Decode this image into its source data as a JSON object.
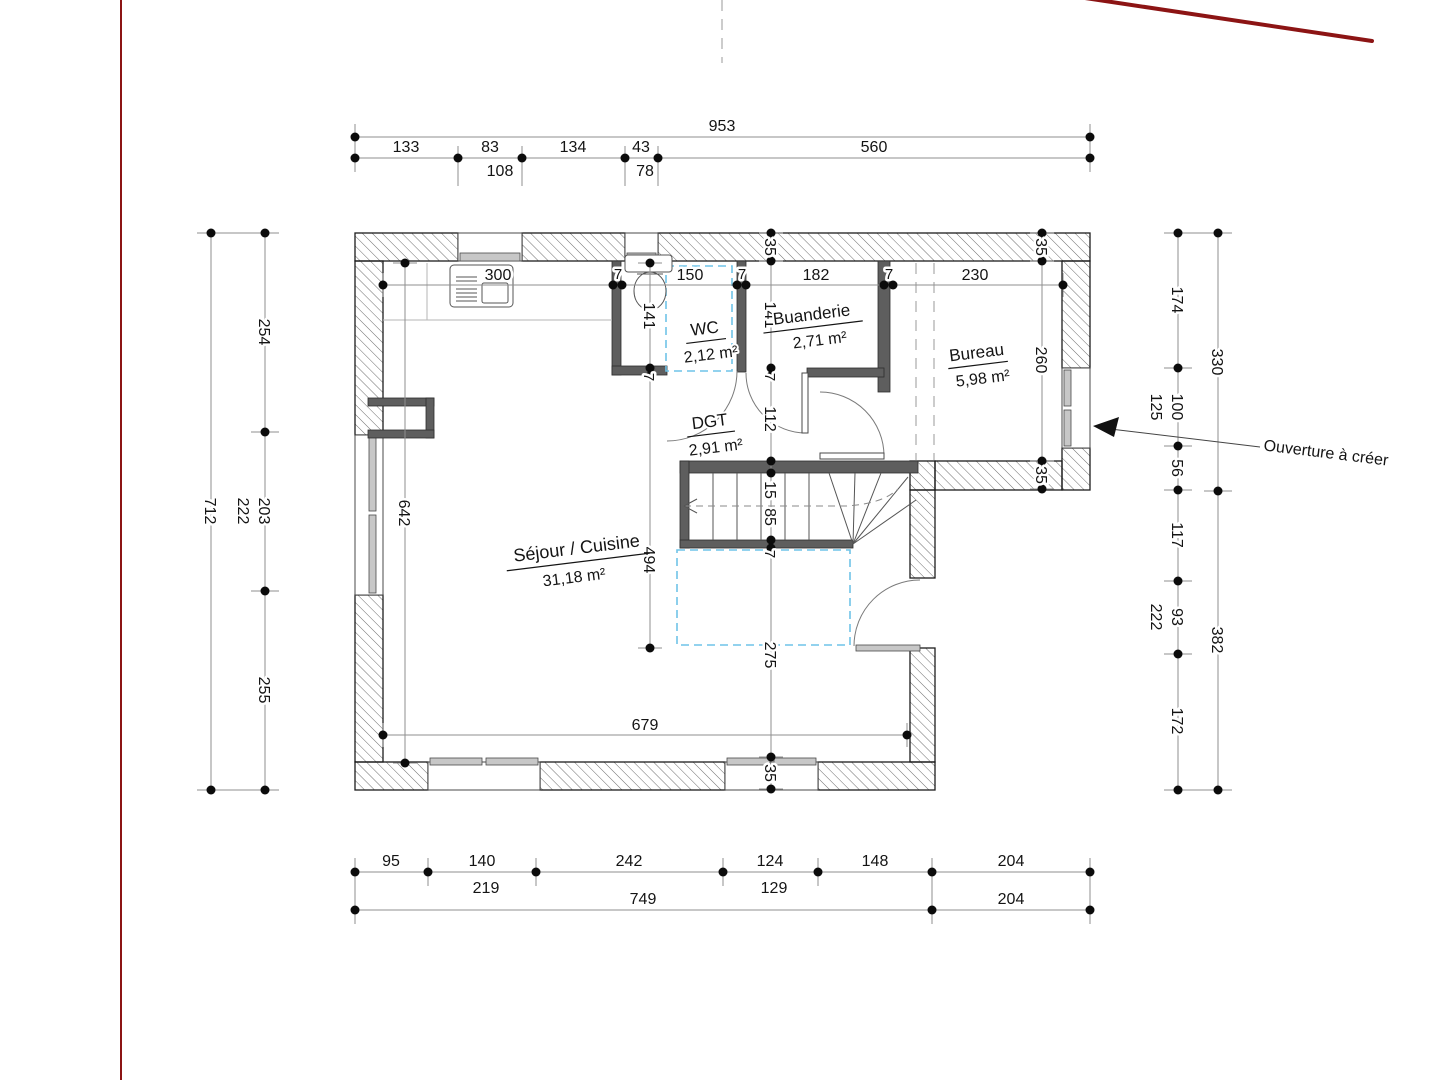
{
  "rooms": {
    "wc": {
      "name": "WC",
      "area": "2,12 m²"
    },
    "buanderie": {
      "name": "Buanderie",
      "area": "2,71 m²"
    },
    "bureau": {
      "name": "Bureau",
      "area": "5,98 m²"
    },
    "dgt": {
      "name": "DGT",
      "area": "2,91 m²"
    },
    "sejour": {
      "name": "Séjour / Cuisine",
      "area": "31,18 m²"
    }
  },
  "annotation": {
    "ouverture": "Ouverture à créer"
  },
  "dims": {
    "top": {
      "total": "953",
      "c": [
        "133",
        "83",
        "134",
        "43",
        "560"
      ],
      "sub": [
        "108",
        "78"
      ]
    },
    "left": {
      "total": "712",
      "c": [
        "254",
        "203",
        "255"
      ],
      "sub": [
        "222"
      ]
    },
    "right": {
      "inner": [
        "174",
        "100",
        "56",
        "117",
        "93",
        "172"
      ],
      "sub": [
        "125",
        "222"
      ],
      "outer": [
        "330",
        "382"
      ]
    },
    "bottom": {
      "c": [
        "95",
        "140",
        "242",
        "124",
        "148",
        "204"
      ],
      "sub": [
        "219",
        "129"
      ],
      "totals": [
        "749",
        "204"
      ]
    },
    "interior": {
      "kitchen": "300",
      "wc_width": "150",
      "buanderie_width": "182",
      "bureau_width": "230",
      "wall7": "7",
      "wall35": "35",
      "wc_depth": "141",
      "buanderie_depth": "141",
      "dgt_height": "112",
      "stair15": "15",
      "stair85": "85",
      "tremie": "275",
      "bureau_window": "260",
      "sejour_width": "679",
      "sejour_window": "642",
      "mid_height": "494"
    }
  },
  "colors": {
    "accent_red": "#8c1414",
    "dashed_blue": "#6fc3e8"
  }
}
